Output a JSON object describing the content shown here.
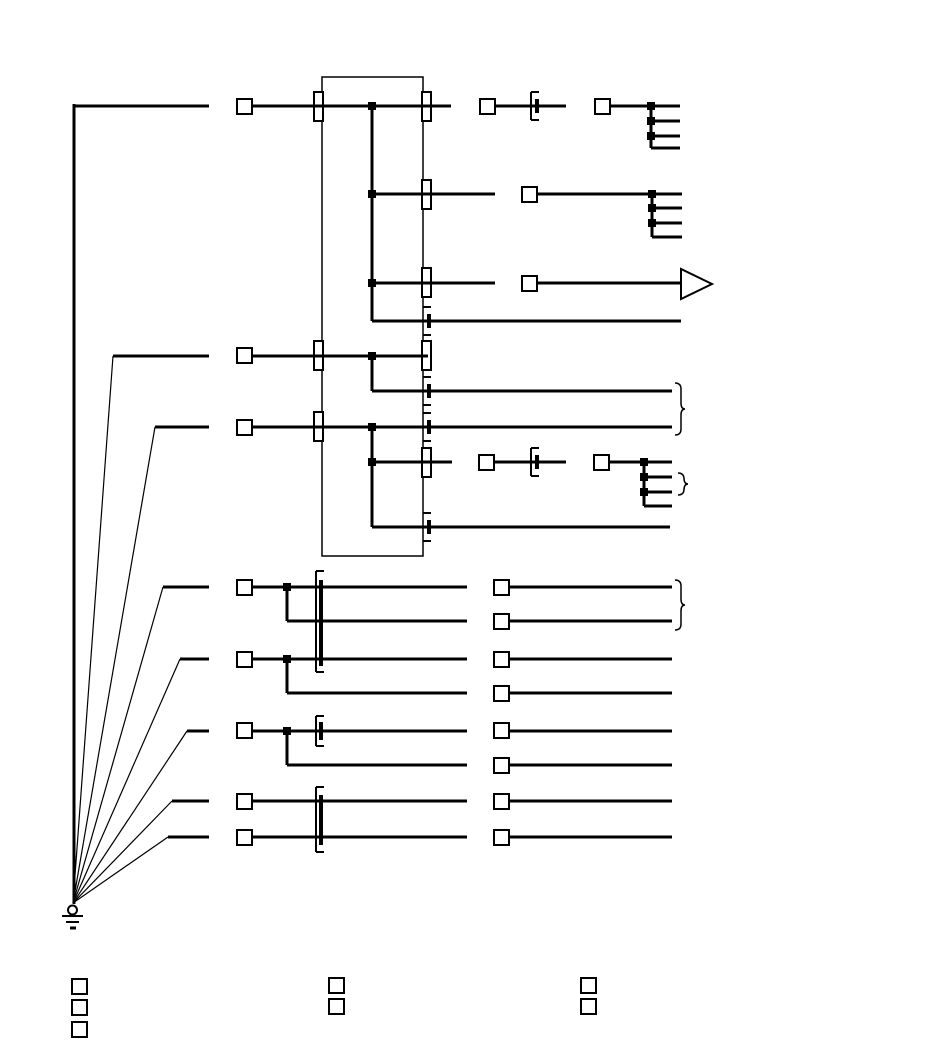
{
  "canvas": {
    "width": 950,
    "height": 1063,
    "viewBox": "0 0 950 1063",
    "background": "#ffffff"
  },
  "diagram": {
    "type": "wiring-harness-schematic",
    "stroke_color": "#000000",
    "fill_color": "#ffffff",
    "symbols": {
      "ground": "earth-ground-symbol",
      "plug_square": "connector-terminal-square",
      "pass_bar": "pass-through-connector-bar",
      "inline_connector": "inline-connector-bracket-with-bar",
      "junction": "wire-junction-dot",
      "arrow": "arrow-terminal",
      "brace": "grouping-brace",
      "legend": "legend-key-square"
    },
    "component_box": {
      "x": 322,
      "y": 77,
      "w": 101,
      "h": 479
    },
    "wires": [
      [
        73,
        106,
        209,
        106
      ],
      [
        74,
        104,
        74,
        904
      ],
      [
        252,
        106,
        451,
        106
      ],
      [
        495,
        106,
        566,
        106
      ],
      [
        609,
        106,
        680,
        106
      ],
      [
        651,
        106,
        651,
        148
      ],
      [
        651,
        121,
        680,
        121
      ],
      [
        651,
        136,
        680,
        136
      ],
      [
        651,
        148,
        680,
        148
      ],
      [
        372,
        106,
        372,
        321
      ],
      [
        372,
        194,
        495,
        194
      ],
      [
        536,
        194,
        682,
        194
      ],
      [
        652,
        194,
        652,
        237
      ],
      [
        652,
        208,
        682,
        208
      ],
      [
        652,
        223,
        682,
        223
      ],
      [
        652,
        237,
        682,
        237
      ],
      [
        372,
        283,
        495,
        283
      ],
      [
        536,
        283,
        681,
        283
      ],
      [
        372,
        321,
        681,
        321
      ],
      [
        113,
        356,
        209,
        356
      ],
      [
        252,
        356,
        428,
        356
      ],
      [
        372,
        356,
        372,
        391
      ],
      [
        372,
        391,
        672,
        391
      ],
      [
        155,
        427,
        209,
        427
      ],
      [
        252,
        427,
        672,
        427
      ],
      [
        372,
        427,
        372,
        527
      ],
      [
        372,
        462,
        452,
        462
      ],
      [
        493,
        462,
        566,
        462
      ],
      [
        609,
        462,
        672,
        462
      ],
      [
        644,
        462,
        644,
        506
      ],
      [
        644,
        477,
        672,
        477
      ],
      [
        644,
        492,
        672,
        492
      ],
      [
        644,
        506,
        672,
        506
      ],
      [
        372,
        527,
        670,
        527
      ],
      [
        163,
        587,
        209,
        587
      ],
      [
        251,
        587,
        467,
        587
      ],
      [
        287,
        587,
        287,
        621
      ],
      [
        287,
        621,
        467,
        621
      ],
      [
        180,
        659,
        209,
        659
      ],
      [
        251,
        659,
        467,
        659
      ],
      [
        287,
        659,
        287,
        693
      ],
      [
        287,
        693,
        467,
        693
      ],
      [
        187,
        731,
        209,
        731
      ],
      [
        251,
        731,
        467,
        731
      ],
      [
        287,
        731,
        287,
        765
      ],
      [
        287,
        765,
        467,
        765
      ],
      [
        172,
        801,
        209,
        801
      ],
      [
        251,
        801,
        467,
        801
      ],
      [
        168,
        837,
        209,
        837
      ],
      [
        251,
        837,
        467,
        837
      ],
      [
        509,
        587,
        672,
        587
      ],
      [
        509,
        621,
        672,
        621
      ],
      [
        509,
        659,
        672,
        659
      ],
      [
        509,
        693,
        672,
        693
      ],
      [
        509,
        731,
        672,
        731
      ],
      [
        509,
        765,
        672,
        765
      ],
      [
        509,
        801,
        672,
        801
      ],
      [
        509,
        837,
        672,
        837
      ]
    ],
    "ground_fan_wires": [
      [
        73,
        903,
        113,
        356
      ],
      [
        73,
        903,
        155,
        427
      ],
      [
        73,
        903,
        163,
        587
      ],
      [
        73,
        903,
        180,
        659
      ],
      [
        73,
        903,
        187,
        731
      ],
      [
        73,
        903,
        172,
        801
      ],
      [
        73,
        903,
        168,
        837
      ]
    ],
    "bracket_lines": [
      [
        531,
        92,
        531,
        120
      ],
      [
        531,
        92,
        539,
        92
      ],
      [
        531,
        120,
        539,
        120
      ],
      [
        531,
        448,
        531,
        476
      ],
      [
        531,
        448,
        539,
        448
      ],
      [
        531,
        476,
        539,
        476
      ],
      [
        423,
        307,
        431,
        307
      ],
      [
        423,
        335,
        431,
        335
      ],
      [
        423,
        377,
        431,
        377
      ],
      [
        423,
        405,
        431,
        405
      ],
      [
        423,
        413,
        431,
        413
      ],
      [
        423,
        441,
        431,
        441
      ],
      [
        423,
        513,
        431,
        513
      ],
      [
        423,
        541,
        431,
        541
      ],
      [
        316,
        571,
        316,
        672
      ],
      [
        316,
        571,
        324,
        571
      ],
      [
        316,
        672,
        324,
        672
      ],
      [
        316,
        716,
        316,
        746
      ],
      [
        316,
        716,
        324,
        716
      ],
      [
        316,
        746,
        324,
        746
      ],
      [
        316,
        787,
        316,
        852
      ],
      [
        316,
        787,
        324,
        787
      ],
      [
        316,
        852,
        324,
        852
      ]
    ],
    "bar_lines": [
      [
        537,
        99,
        537,
        113
      ],
      [
        537,
        455,
        537,
        469
      ],
      [
        429,
        314,
        429,
        328
      ],
      [
        429,
        384,
        429,
        398
      ],
      [
        429,
        420,
        429,
        434
      ],
      [
        429,
        520,
        429,
        534
      ],
      [
        321,
        580,
        321,
        666
      ],
      [
        321,
        722,
        321,
        740
      ],
      [
        321,
        795,
        321,
        845
      ]
    ],
    "pass_connectors": [
      [
        314,
        92
      ],
      [
        314,
        341
      ],
      [
        314,
        412
      ],
      [
        422,
        92
      ],
      [
        422,
        180
      ],
      [
        422,
        268
      ],
      [
        422,
        341
      ],
      [
        422,
        448
      ]
    ],
    "pass_connector_size": {
      "w": 9,
      "h": 29
    },
    "plug_squares": [
      [
        237,
        99
      ],
      [
        237,
        348
      ],
      [
        237,
        420
      ],
      [
        237,
        580
      ],
      [
        237,
        652
      ],
      [
        237,
        723
      ],
      [
        237,
        794
      ],
      [
        237,
        830
      ],
      [
        480,
        99
      ],
      [
        595,
        99
      ],
      [
        522,
        187
      ],
      [
        522,
        276
      ],
      [
        479,
        455
      ],
      [
        594,
        455
      ],
      [
        494,
        580
      ],
      [
        494,
        614
      ],
      [
        494,
        652
      ],
      [
        494,
        686
      ],
      [
        494,
        723
      ],
      [
        494,
        758
      ],
      [
        494,
        794
      ],
      [
        494,
        830
      ]
    ],
    "plug_square_size": 15,
    "junction_dots": [
      [
        372,
        106
      ],
      [
        372,
        194
      ],
      [
        372,
        283
      ],
      [
        372,
        356
      ],
      [
        372,
        427
      ],
      [
        372,
        462
      ],
      [
        651,
        106
      ],
      [
        651,
        121
      ],
      [
        651,
        136
      ],
      [
        652,
        194
      ],
      [
        652,
        208
      ],
      [
        652,
        223
      ],
      [
        644,
        462
      ],
      [
        644,
        477
      ],
      [
        644,
        492
      ],
      [
        287,
        587
      ],
      [
        287,
        659
      ],
      [
        287,
        731
      ]
    ],
    "junction_dot_size": 8,
    "arrow_terminal": {
      "points": "681,269 681,299 712,284"
    },
    "braces": [
      {
        "x": 675,
        "y1": 383,
        "y2": 435
      },
      {
        "x": 678,
        "y1": 473,
        "y2": 495
      },
      {
        "x": 675,
        "y1": 580,
        "y2": 630
      }
    ],
    "ground": {
      "circle": {
        "cx": 72.5,
        "cy": 910,
        "r": 4.5
      },
      "lines": [
        [
          62,
          916,
          83,
          916
        ],
        [
          66,
          922,
          79,
          922
        ],
        [
          70,
          928,
          76,
          928
        ]
      ]
    },
    "legend_squares": [
      [
        72,
        979
      ],
      [
        72,
        1000
      ],
      [
        72,
        1022
      ],
      [
        329,
        978
      ],
      [
        329,
        999
      ],
      [
        581,
        978
      ],
      [
        581,
        999
      ]
    ],
    "legend_square_size": 15
  }
}
